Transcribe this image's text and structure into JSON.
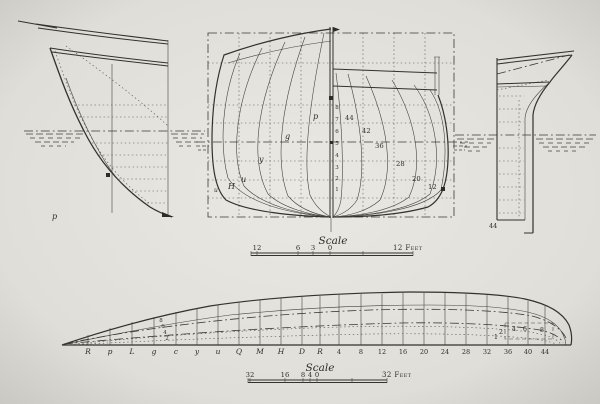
{
  "colors": {
    "paper_center": "#e9e7e1",
    "paper_edge": "#c8c6c1",
    "ink": "#2e2c28"
  },
  "bow_profile": {
    "mark_label": "p"
  },
  "body_plan": {
    "fore_section_labels": [
      "p",
      "g",
      "y",
      "u",
      "H"
    ],
    "fore_edge_label": "u",
    "aft_section_labels": [
      "44",
      "42",
      "36",
      "28",
      "20",
      "12"
    ],
    "waterline_numbers": [
      "8",
      "7",
      "6",
      "5",
      "4",
      "3",
      "2",
      "1"
    ]
  },
  "stern_profile": {
    "label": "44"
  },
  "half_breadth_plan": {
    "station_labels": [
      "R",
      "p",
      "L",
      "g",
      "c",
      "y",
      "u",
      "Q",
      "M",
      "H",
      "D",
      "R",
      "4",
      "8",
      "12",
      "16",
      "20",
      "24",
      "28",
      "32",
      "36",
      "40",
      "44"
    ],
    "offset_labels": [
      "1",
      "2",
      "4",
      "6",
      "8"
    ],
    "bow_waterline_labels": [
      "8",
      "6",
      "4",
      "2"
    ]
  },
  "scales": {
    "upper": {
      "title": "Scale",
      "tick_labels": [
        "12",
        "6",
        "3",
        "0"
      ],
      "end_label": "12 Feet"
    },
    "lower": {
      "title": "Scale",
      "tick_labels": [
        "32",
        "16",
        "8",
        "4",
        "0"
      ],
      "end_label": "32 Feet"
    }
  }
}
